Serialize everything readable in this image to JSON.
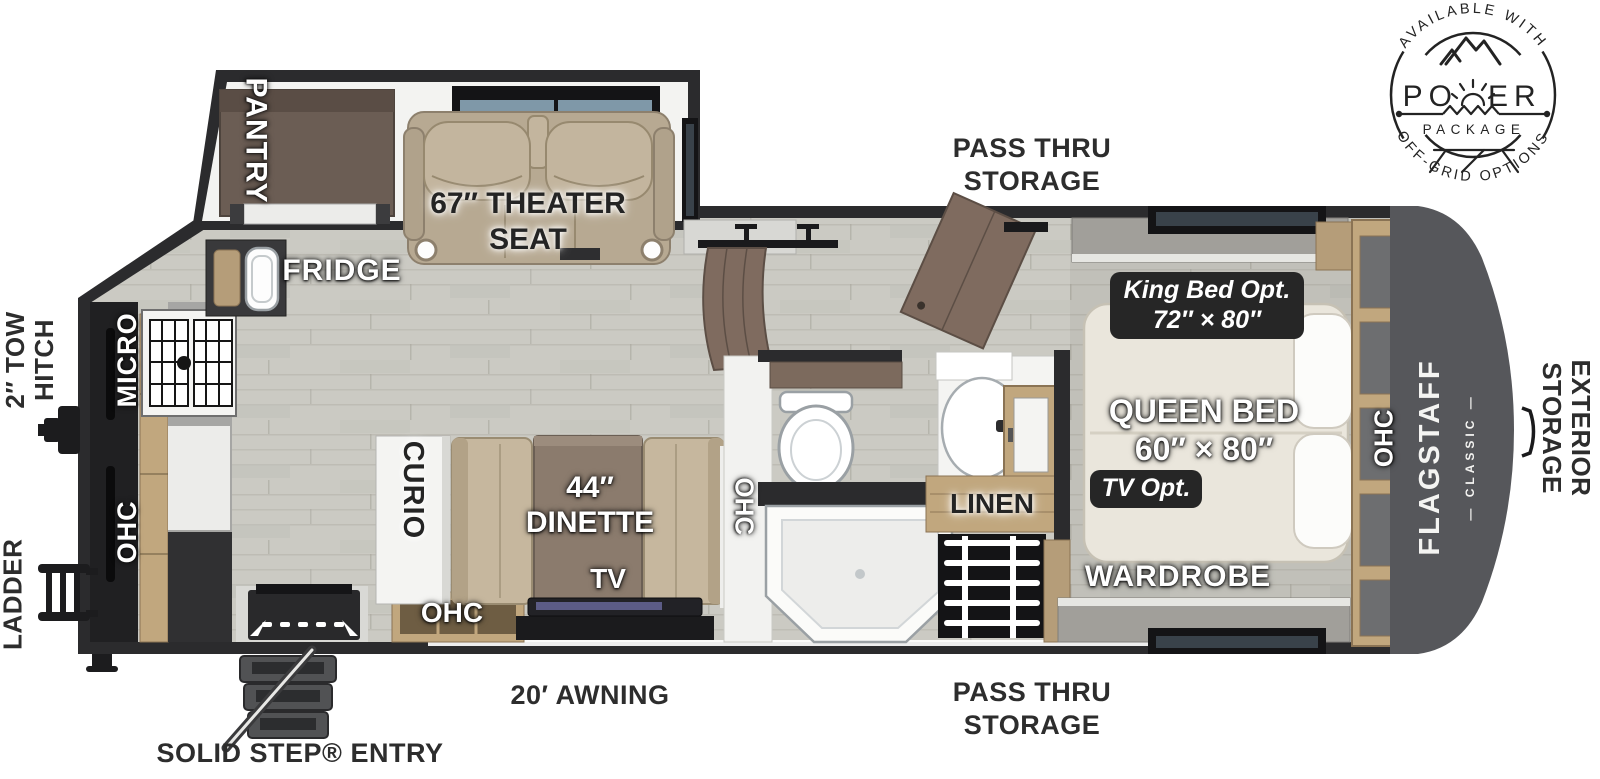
{
  "page": {
    "background": "#ffffff"
  },
  "colors": {
    "wall": "#2b2b2d",
    "floor": "#cbcac3",
    "wood_cabinet": "#c1a77e",
    "rear_cap": "#56575b",
    "seat_tan": "#b7a992",
    "badge_bg": "#262626",
    "label_dark": "#2d2d2d",
    "door_brown": "#7f6b5f"
  },
  "badge_logo": {
    "arc_top": "AVAILABLE WITH",
    "word": "POWER",
    "word_left": "PO",
    "word_right": "ER",
    "package": "PACKAGE",
    "arc_bottom": "OFF-GRID OPTIONS"
  },
  "exterior": {
    "pass_thru_top": {
      "line1": "PASS THRU",
      "line2": "STORAGE"
    },
    "pass_thru_bottom": {
      "line1": "PASS THRU",
      "line2": "STORAGE"
    },
    "tow_hitch": {
      "line1": "2″ TOW",
      "line2": "HITCH"
    },
    "ladder": "LADDER",
    "exterior_storage": {
      "line1": "EXTERIOR",
      "line2": "STORAGE"
    },
    "awning": "20′ AWNING",
    "entry": "SOLID STEP® ENTRY"
  },
  "interior": {
    "kitchen": {
      "pantry": "PANTRY",
      "fridge": "FRIDGE",
      "micro": "MICRO",
      "ohc": "OHC"
    },
    "living": {
      "theater_line1": "67″ THEATER",
      "theater_line2": "SEAT",
      "curio": "CURIO",
      "dinette_line1": "44″",
      "dinette_line2": "DINETTE",
      "tv": "TV",
      "ohc_bottom": "OHC",
      "ohc_side": "OHC"
    },
    "bath": {
      "linen": "LINEN"
    },
    "bedroom": {
      "king_line1": "King Bed Opt.",
      "king_line2": "72″ × 80″",
      "queen_line1": "QUEEN BED",
      "queen_line2": "60″ × 80″",
      "tv_opt": "TV Opt.",
      "wardrobe": "WARDROBE",
      "ohc": "OHC"
    },
    "rear": {
      "brand": "FLAGSTAFF",
      "model": "— CLASSIC —"
    }
  }
}
